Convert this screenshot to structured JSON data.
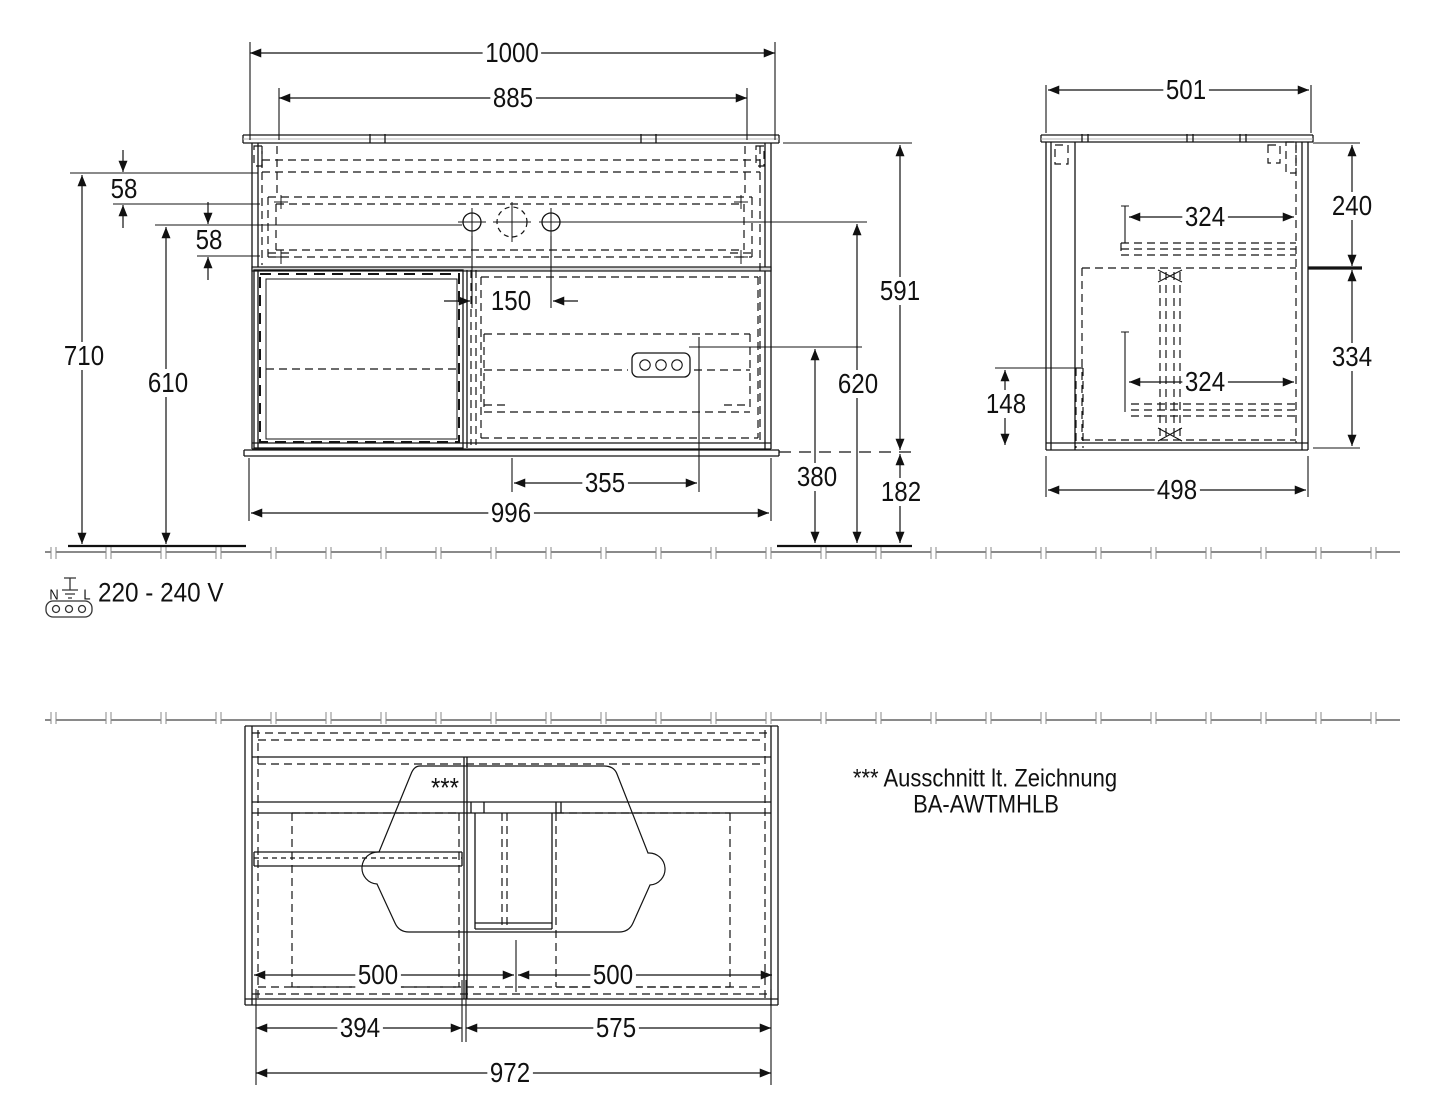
{
  "front": {
    "top_width": "1000",
    "basin_width": "885",
    "basin_rim_drop": "58",
    "drawer_top_gap": "58",
    "tap_hole_spacing": "150",
    "wall_height": "710",
    "drawer_ref_height": "610",
    "carcass_height": "591",
    "tap_hole_height": "620",
    "socket_height": "380",
    "floor_clearance": "182",
    "socket_offset": "355",
    "carcass_width": "996"
  },
  "side": {
    "top_depth": "501",
    "upper_section_height": "240",
    "upper_drawer_depth": "324",
    "lower_section_height": "334",
    "lower_drawer_depth": "324",
    "service_cutout_height": "148",
    "carcass_depth": "498"
  },
  "bottom": {
    "left_section_width": "500",
    "right_section_width": "500",
    "left_module_width": "394",
    "right_module_width": "575",
    "carcass_width": "972",
    "cutout_marker": "***"
  },
  "power": {
    "neutral": "N",
    "line": "L",
    "voltage": "220 - 240 V"
  },
  "note": {
    "line1": "*** Ausschnitt lt. Zeichnung",
    "line2": "BA-AWTMHLB"
  }
}
